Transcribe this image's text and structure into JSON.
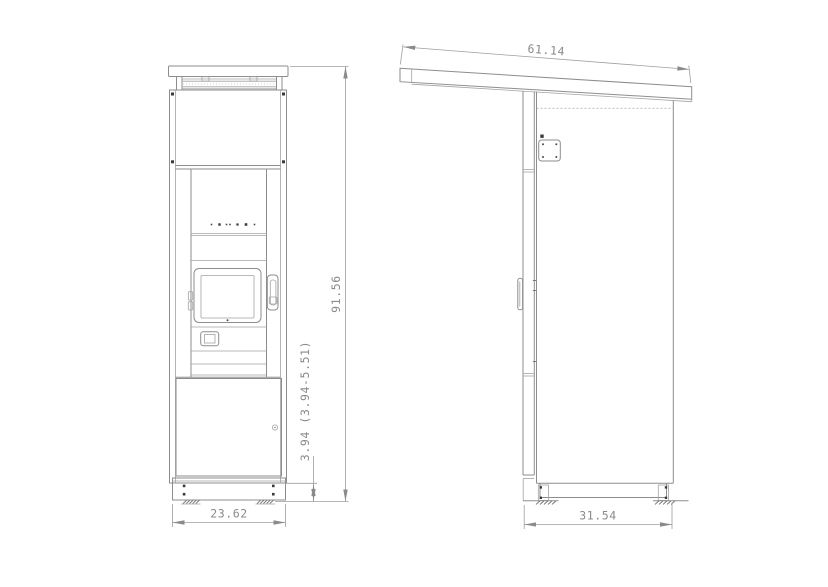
{
  "drawing": {
    "dims": {
      "roof_depth": "61.14",
      "overall_height": "91.56",
      "base_height": "3.94 (3.94-5.51)",
      "front_width": "23.62",
      "side_depth": "31.54"
    },
    "colors": {
      "line": "#8d8d8d",
      "dimension": "#9e9e9e",
      "text": "#8a8a8a",
      "mark": "#3a3a3a",
      "background": "#ffffff"
    }
  }
}
